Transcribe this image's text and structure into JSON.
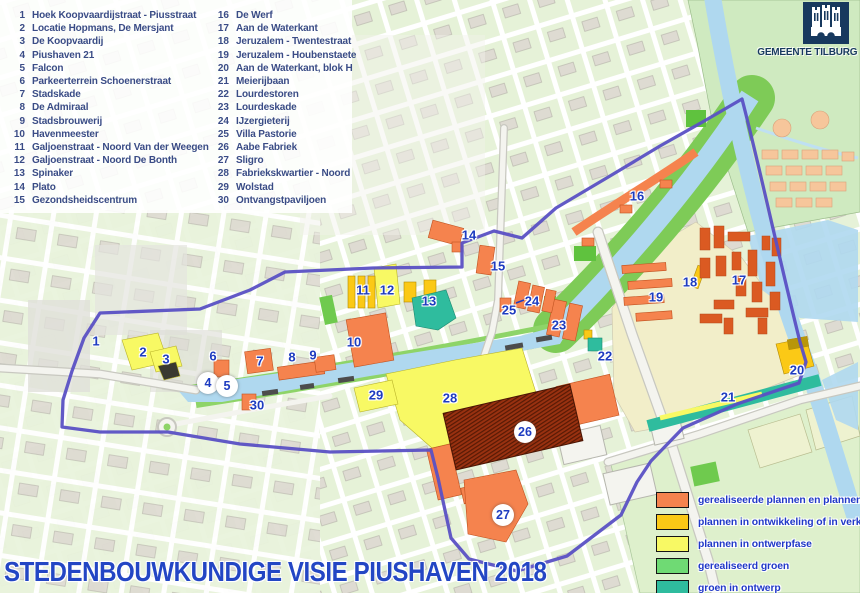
{
  "title": "STEDENBOUWKUNDIGE VISIE PIUSHAVEN 2018",
  "header": {
    "logo_text": "GEMEENTE TILBURG"
  },
  "projects": {
    "col1": [
      {
        "n": "1",
        "name": "Hoek Koopvaardijstraat - Piusstraat"
      },
      {
        "n": "2",
        "name": "Locatie Hopmans, De Mersjant"
      },
      {
        "n": "3",
        "name": "De Koopvaardij"
      },
      {
        "n": "4",
        "name": "Piushaven 21"
      },
      {
        "n": "5",
        "name": "Falcon"
      },
      {
        "n": "6",
        "name": "Parkeerterrein Schoenerstraat"
      },
      {
        "n": "7",
        "name": "Stadskade"
      },
      {
        "n": "8",
        "name": "De Admiraal"
      },
      {
        "n": "9",
        "name": "Stadsbrouwerij"
      },
      {
        "n": "10",
        "name": "Havenmeester"
      },
      {
        "n": "11",
        "name": "Galjoenstraat - Noord Van der Weegen"
      },
      {
        "n": "12",
        "name": "Galjoenstraat - Noord De Bonth"
      },
      {
        "n": "13",
        "name": "Spinaker"
      },
      {
        "n": "14",
        "name": "Plato"
      },
      {
        "n": "15",
        "name": "Gezondsheidscentrum"
      }
    ],
    "col2": [
      {
        "n": "16",
        "name": "De Werf"
      },
      {
        "n": "17",
        "name": "Aan de Waterkant"
      },
      {
        "n": "18",
        "name": "Jeruzalem - Twentestraat"
      },
      {
        "n": "19",
        "name": "Jeruzalem - Houbenstaete"
      },
      {
        "n": "20",
        "name": "Aan de Waterkant, blok H"
      },
      {
        "n": "21",
        "name": "Meierijbaan"
      },
      {
        "n": "22",
        "name": "Lourdestoren"
      },
      {
        "n": "23",
        "name": "Lourdeskade"
      },
      {
        "n": "24",
        "name": "IJzergieterij"
      },
      {
        "n": "25",
        "name": "Villa Pastorie"
      },
      {
        "n": "26",
        "name": "Aabe Fabriek"
      },
      {
        "n": "27",
        "name": "Sligro"
      },
      {
        "n": "28",
        "name": "Fabriekskwartier - Noord"
      },
      {
        "n": "29",
        "name": "Wolstad"
      },
      {
        "n": "30",
        "name": "Ontvangstpaviljoen"
      }
    ]
  },
  "legend": {
    "items": [
      {
        "label": "gerealiseerde plannen en plannen in aanbouw",
        "color": "#F5834E"
      },
      {
        "label": "plannen in ontwikkeling of in verkoop",
        "color": "#FBC916"
      },
      {
        "label": "plannen in ontwerpfase",
        "color": "#F8F964"
      },
      {
        "label": "gerealiseerd groen",
        "color": "#6FDA74"
      },
      {
        "label": "groen in ontwerp",
        "color": "#2FBC9E"
      }
    ]
  },
  "markers": [
    {
      "n": "1",
      "x": 96,
      "y": 341
    },
    {
      "n": "2",
      "x": 143,
      "y": 352
    },
    {
      "n": "3",
      "x": 166,
      "y": 359
    },
    {
      "n": "4",
      "x": 208,
      "y": 383,
      "badge": true
    },
    {
      "n": "5",
      "x": 227,
      "y": 386,
      "badge": true
    },
    {
      "n": "6",
      "x": 213,
      "y": 356
    },
    {
      "n": "7",
      "x": 260,
      "y": 361
    },
    {
      "n": "8",
      "x": 292,
      "y": 357
    },
    {
      "n": "9",
      "x": 313,
      "y": 355
    },
    {
      "n": "10",
      "x": 354,
      "y": 342
    },
    {
      "n": "11",
      "x": 363,
      "y": 290
    },
    {
      "n": "12",
      "x": 387,
      "y": 290
    },
    {
      "n": "13",
      "x": 429,
      "y": 301
    },
    {
      "n": "14",
      "x": 469,
      "y": 235
    },
    {
      "n": "15",
      "x": 498,
      "y": 266
    },
    {
      "n": "16",
      "x": 637,
      "y": 196
    },
    {
      "n": "17",
      "x": 739,
      "y": 280
    },
    {
      "n": "18",
      "x": 690,
      "y": 282
    },
    {
      "n": "19",
      "x": 656,
      "y": 297
    },
    {
      "n": "20",
      "x": 797,
      "y": 370
    },
    {
      "n": "21",
      "x": 728,
      "y": 397
    },
    {
      "n": "22",
      "x": 605,
      "y": 356
    },
    {
      "n": "23",
      "x": 559,
      "y": 325
    },
    {
      "n": "24",
      "x": 532,
      "y": 301
    },
    {
      "n": "25",
      "x": 509,
      "y": 310
    },
    {
      "n": "26",
      "x": 525,
      "y": 432,
      "badge": true
    },
    {
      "n": "27",
      "x": 503,
      "y": 515,
      "badge": true
    },
    {
      "n": "28",
      "x": 450,
      "y": 398
    },
    {
      "n": "29",
      "x": 376,
      "y": 395
    },
    {
      "n": "30",
      "x": 257,
      "y": 405
    }
  ],
  "colors": {
    "water": "#AFD8EF",
    "boundary": "#5A50C4",
    "numblue": "#1E3CC0",
    "titleblue": "#2346C4",
    "listtext": "#3A4C86",
    "legendtext": "#2038C8",
    "logonavy": "#17395E"
  }
}
